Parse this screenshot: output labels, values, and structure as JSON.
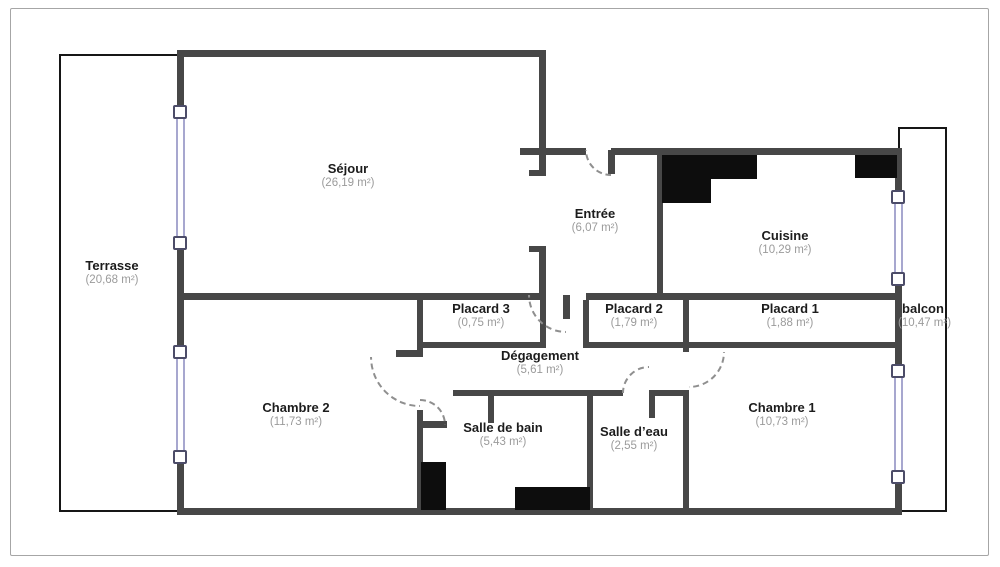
{
  "plan_title": "Plan d'appartement",
  "rooms": {
    "terrasse": {
      "name": "Terrasse",
      "area": "(20,68 m²)"
    },
    "sejour": {
      "name": "Séjour",
      "area": "(26,19 m²)"
    },
    "entree": {
      "name": "Entrée",
      "area": "(6,07 m²)"
    },
    "cuisine": {
      "name": "Cuisine",
      "area": "(10,29 m²)"
    },
    "placard3": {
      "name": "Placard 3",
      "area": "(0,75 m²)"
    },
    "placard2": {
      "name": "Placard 2",
      "area": "(1,79 m²)"
    },
    "placard1": {
      "name": "Placard 1",
      "area": "(1,88 m²)"
    },
    "balcon": {
      "name": "balcon",
      "area": "(10,47 m²)"
    },
    "degagement": {
      "name": "Dégagement",
      "area": "(5,61 m²)"
    },
    "chambre2": {
      "name": "Chambre 2",
      "area": "(11,73 m²)"
    },
    "salle_de_bain": {
      "name": "Salle de bain",
      "area": "(5,43 m²)"
    },
    "salle_deau": {
      "name": "Salle d’eau",
      "area": "(2,55 m²)"
    },
    "chambre1": {
      "name": "Chambre 1",
      "area": "(10,73 m²)"
    }
  },
  "colors": {
    "wall": "#474747",
    "thin_wall": "#161616",
    "fixture": "#0d0d0d",
    "window_frame": "#a7a7cf",
    "room_name_text": "#1c1c1c",
    "area_text": "#9b9b9b"
  }
}
